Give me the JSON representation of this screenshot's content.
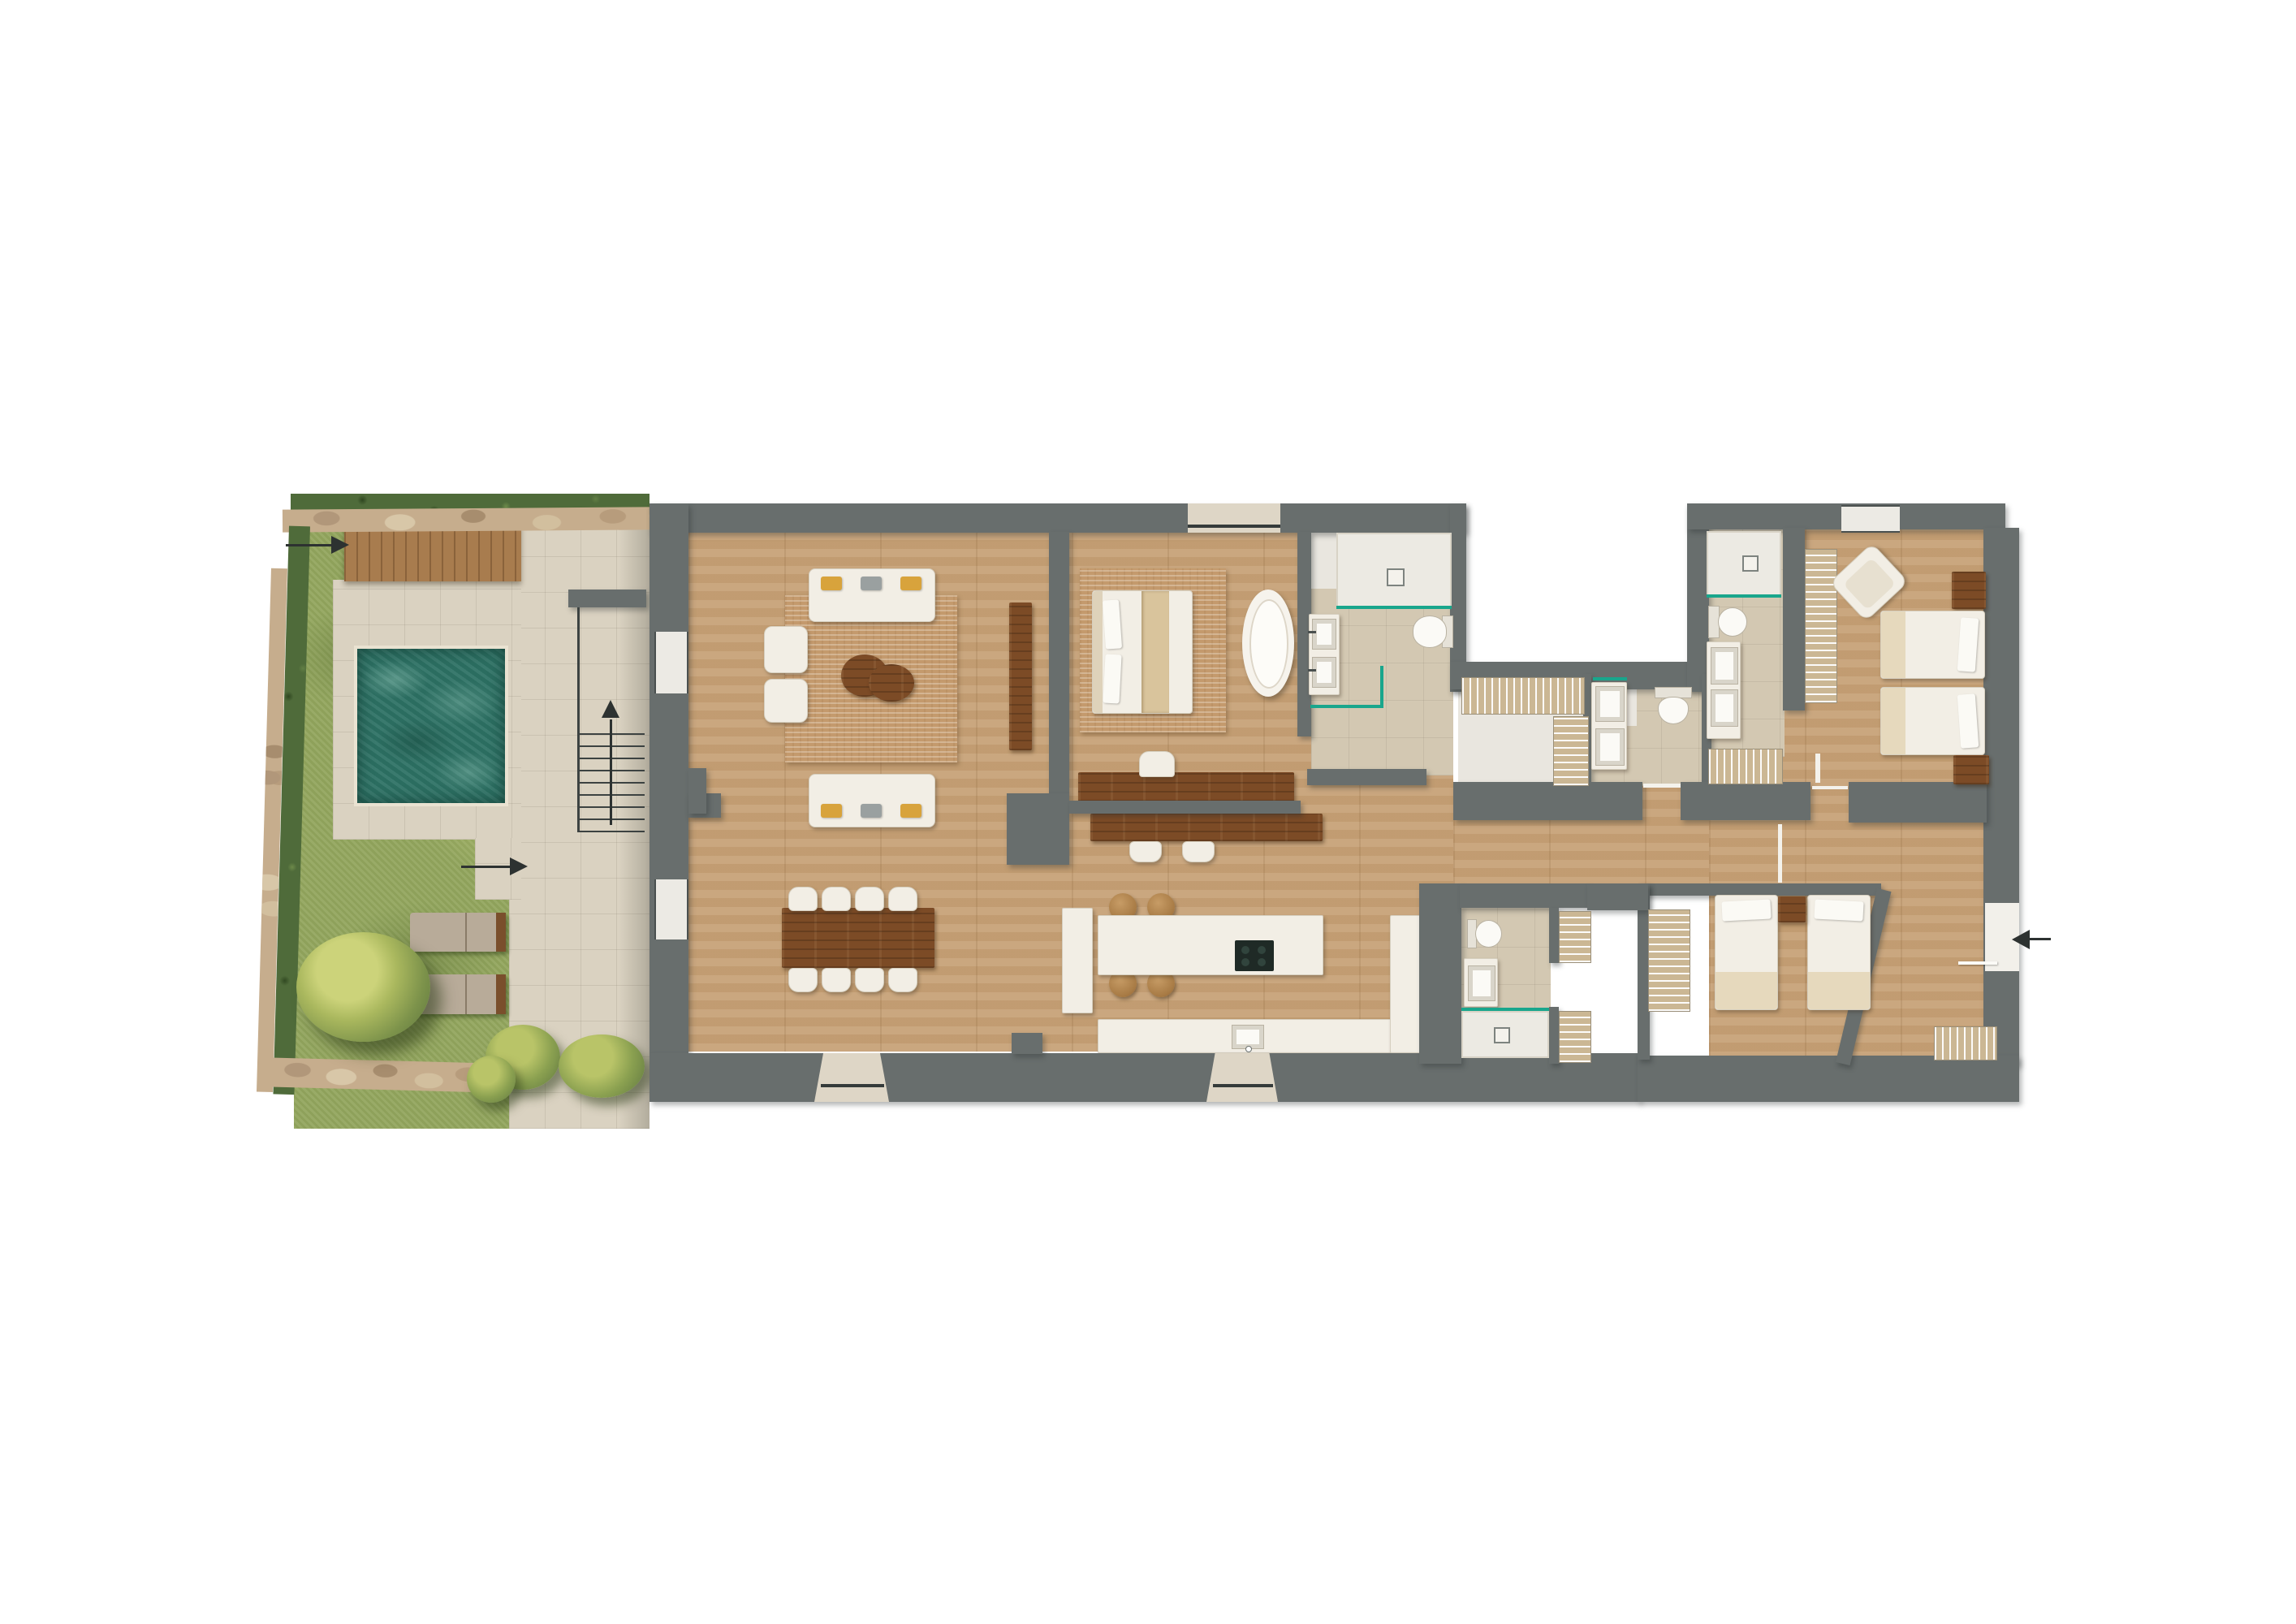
{
  "type": "architectural-floor-plan",
  "palette": {
    "wall": "#686e6d",
    "wood": "#c7a277",
    "wooddark": "#7c4b26",
    "furn": "#f2eee5",
    "furnborder": "#d6cfbf",
    "tile": "#d3c8b2",
    "whitefloor": "#e9e6df",
    "terrace": "#dad2c1",
    "grass": "#94a75f",
    "hedge": "#4f6b3a",
    "stone": "#c6ad8d",
    "deck": "#a87c4e",
    "pool": "#2e7265",
    "pooledge": "#e9e2d1",
    "teal": "#19a68c",
    "rug": "#c49a6d",
    "gold": "#d8a33c",
    "graypillow": "#9aa0a0",
    "arrow": "#2d3231",
    "window": "#eceae4",
    "doorlight": "#ded6c6"
  },
  "icons": {
    "entry_arrow_west": "→",
    "path_arrow": "→",
    "stairs_up_arrow": "↑",
    "entry_arrow_east": "◀"
  },
  "scene": {
    "garden": {
      "features": [
        "stone-boundary-wall",
        "hedge-row",
        "lawn",
        "timber-deck",
        "swimming-pool",
        "pool-terrace",
        "paved-walkway",
        "exterior-stairs",
        "sun-lounger",
        "sun-lounger",
        "large-shrub",
        "bushes",
        "entry-arrow-west",
        "garden-path-arrow",
        "stairs-up-arrow"
      ]
    },
    "house": {
      "rooms": [
        {
          "id": "living-room",
          "contents": [
            "sofa",
            "sofa",
            "armchair",
            "armchair",
            "oval-coffee-table",
            "area-rug",
            "tall-bookcase",
            "fireplace-nook"
          ]
        },
        {
          "id": "dining-area",
          "contents": [
            "rectangular-dining-table",
            "dining-chairs-x8"
          ]
        },
        {
          "id": "kitchen",
          "contents": [
            "island-with-cooktop",
            "round-stools-x4",
            "counter-with-sink",
            "tall-cabinet"
          ]
        },
        {
          "id": "master-bedroom",
          "contents": [
            "double-bed",
            "area-rug",
            "freestanding-bathtub",
            "writing-desk",
            "desk-chair",
            "low-console",
            "stools-x2"
          ]
        },
        {
          "id": "master-bathroom",
          "contents": [
            "double-vanity",
            "walk-in-shower",
            "toilet",
            "glass-screen"
          ]
        },
        {
          "id": "dressing-corridor",
          "contents": [
            "wardrobe-rail",
            "wardrobe-rail"
          ]
        },
        {
          "id": "wc",
          "contents": [
            "double-vanity",
            "toilet"
          ]
        },
        {
          "id": "bathroom-2",
          "contents": [
            "walk-in-shower",
            "toilet",
            "double-vanity",
            "towel-radiator"
          ]
        },
        {
          "id": "bedroom-2",
          "contents": [
            "twin-bed",
            "twin-bed",
            "nightstand",
            "nightstand",
            "corner-armchair",
            "slatted-wardrobe"
          ]
        },
        {
          "id": "bathroom-3",
          "contents": [
            "toilet",
            "vanity",
            "walk-in-shower",
            "glass-screen"
          ]
        },
        {
          "id": "bedroom-3",
          "contents": [
            "twin-bed",
            "twin-bed",
            "nightstand",
            "slatted-wardrobe",
            "towel-radiator"
          ]
        },
        {
          "id": "entry-vestibule",
          "contents": [
            "entry-door",
            "door-swing",
            "entry-arrow-east",
            "towel-radiator"
          ]
        },
        {
          "id": "hallway",
          "contents": [
            "thresholds"
          ]
        }
      ],
      "openings": [
        "west-window",
        "west-window",
        "north-glazed-door",
        "north-window",
        "south-porch-door",
        "south-porch-door",
        "east-entry-door"
      ]
    }
  }
}
